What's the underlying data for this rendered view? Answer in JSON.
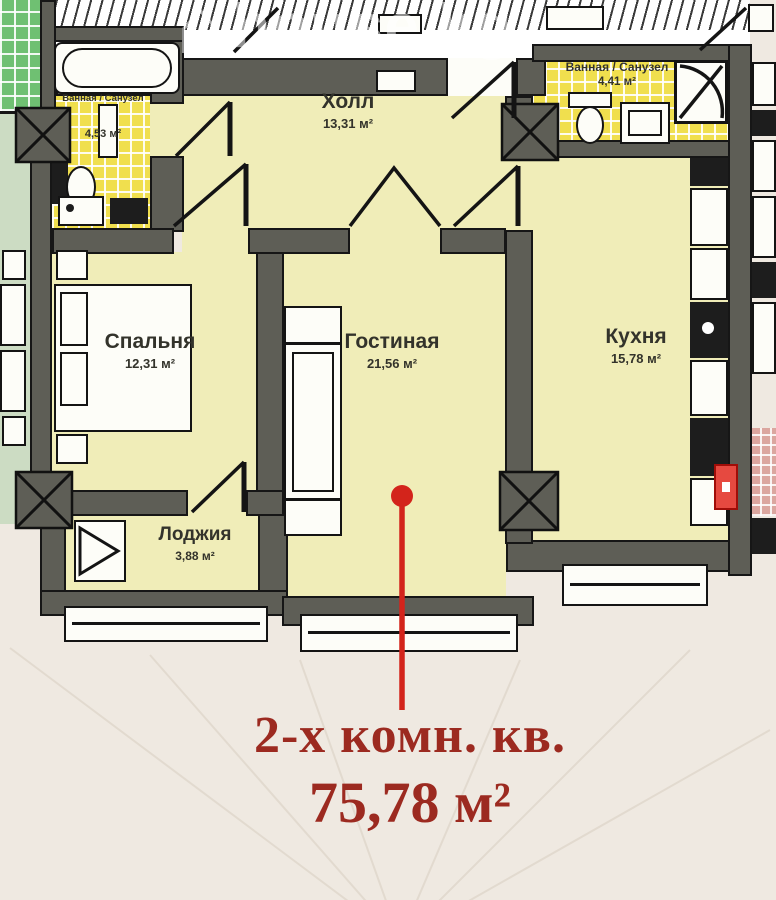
{
  "watermark": {
    "icon_glyph": "⌂",
    "text": "house.kg"
  },
  "rooms": {
    "hall": {
      "name": "Холл",
      "area": "13,31 м²"
    },
    "bath_left": {
      "name": "Ванная / Санузел",
      "area": "4,53 м²"
    },
    "bath_right": {
      "name": "Ванная / Санузел",
      "area": "4,41 м²"
    },
    "bedroom": {
      "name": "Спальня",
      "area": "12,31 м²"
    },
    "living": {
      "name": "Гостиная",
      "area": "21,56 м²"
    },
    "kitchen": {
      "name": "Кухня",
      "area": "15,78 м²"
    },
    "loggia": {
      "name": "Лоджия",
      "area": "3,88 м²"
    }
  },
  "callout": {
    "title": "2-х комн. кв.",
    "area": "75,78 м²"
  },
  "colors": {
    "page_bg": "#efe9e1",
    "room_fill": "#f0edb8",
    "tile_yellow": "#f0df4e",
    "tile_green": "#6fc072",
    "tile_green_light": "#ccdcc3",
    "tile_pink": "#dba69f",
    "wall_gray": "#5e5e56",
    "accent_red": "#d3241b",
    "text_red": "#9c2a20",
    "label_ink": "#33332b"
  }
}
